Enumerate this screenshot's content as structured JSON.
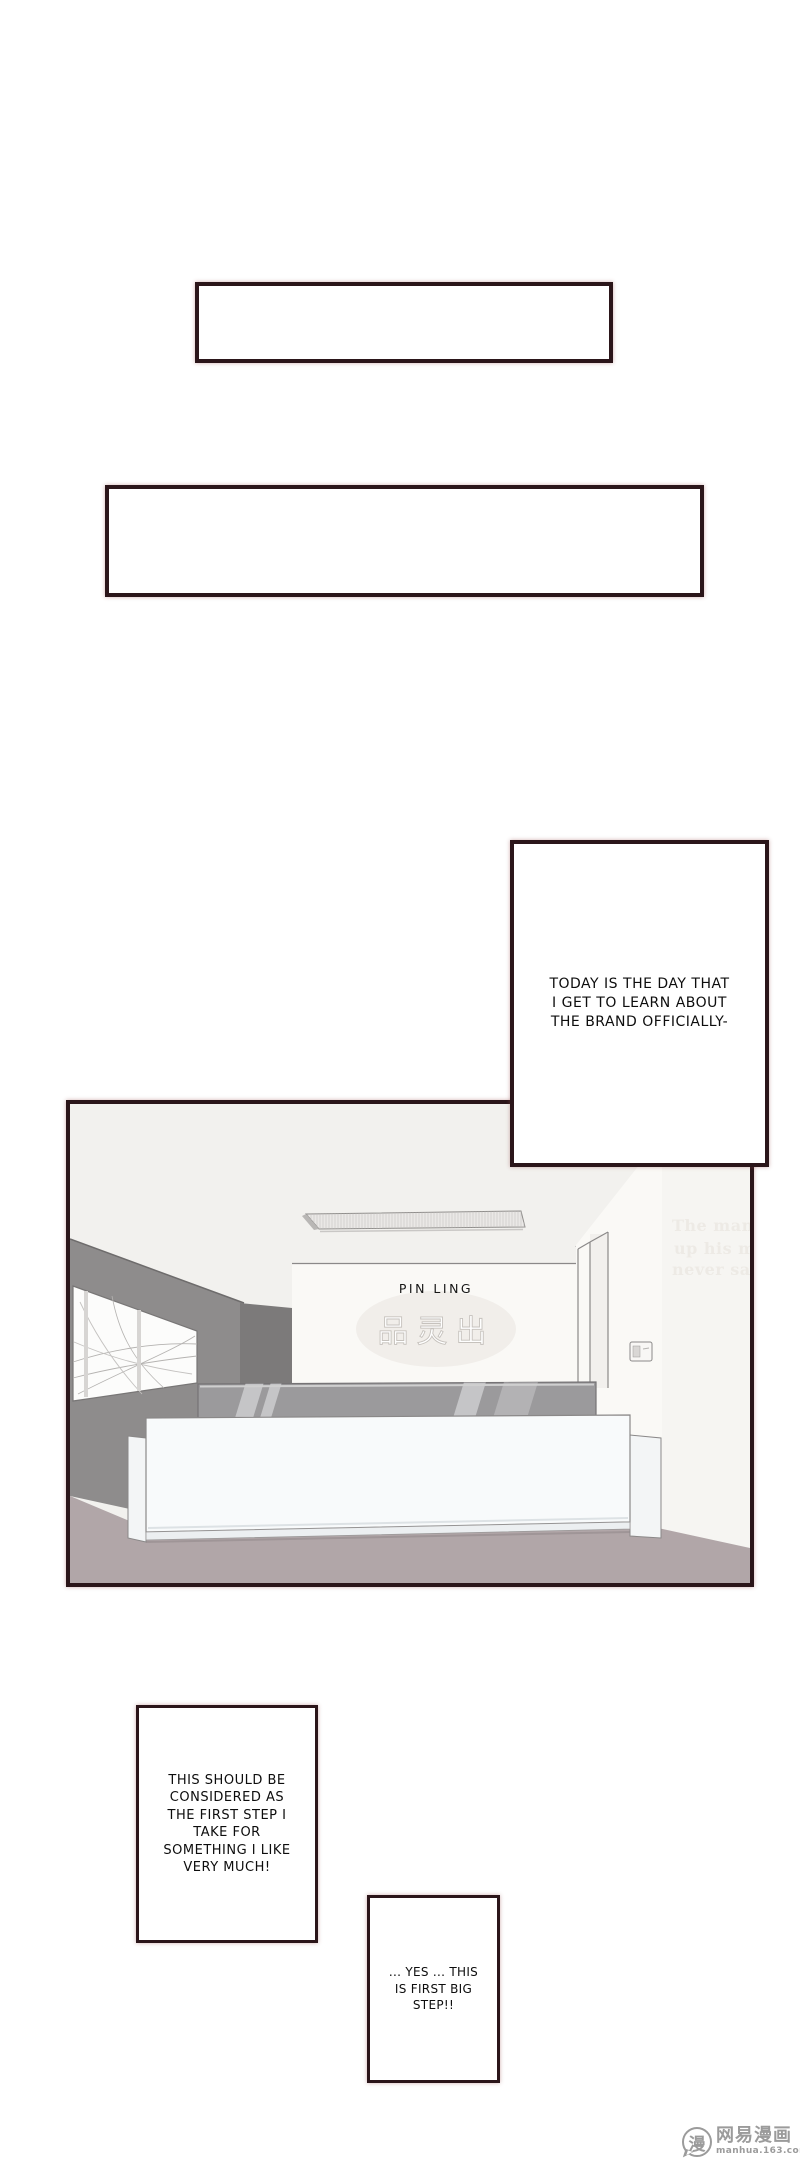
{
  "speech_boxes": {
    "today": {
      "text": "TODAY IS THE DAY THAT\nI GET TO LEARN ABOUT\nTHE BRAND OFFICIALLY-"
    },
    "first_step": {
      "text": "THIS SHOULD BE\nCONSIDERED AS\nTHE FIRST STEP I\nTAKE FOR\nSOMETHING I LIKE\nVERY MUCH!"
    },
    "big_step": {
      "text": "... YES ... THIS\nIS FIRST BIG\nSTEP!!"
    }
  },
  "scene": {
    "sign_text": "PIN LING",
    "sign_chinese": "品灵出",
    "wall_watermark": {
      "line1": "The man",
      "line2": "up his mi",
      "line3": "never sa"
    },
    "colors": {
      "ceiling": "#f2f1ee",
      "left_wall": "#8e8c8c",
      "pillar": "#7c7a7a",
      "sign_wall": "#faf9f6",
      "right_wall": "#f6f5f2",
      "floor": "#b1a6a8",
      "desk_front": "#f8fafb",
      "desk_band": "#9b9a9c",
      "band_stripe_light": "#c5c5c7",
      "band_stripe_mid": "#b3b2b4",
      "panel_border": "#2b161a"
    }
  },
  "footer": {
    "logo_char": "漫",
    "brand": "网易漫画",
    "url": "manhua.163.com"
  }
}
